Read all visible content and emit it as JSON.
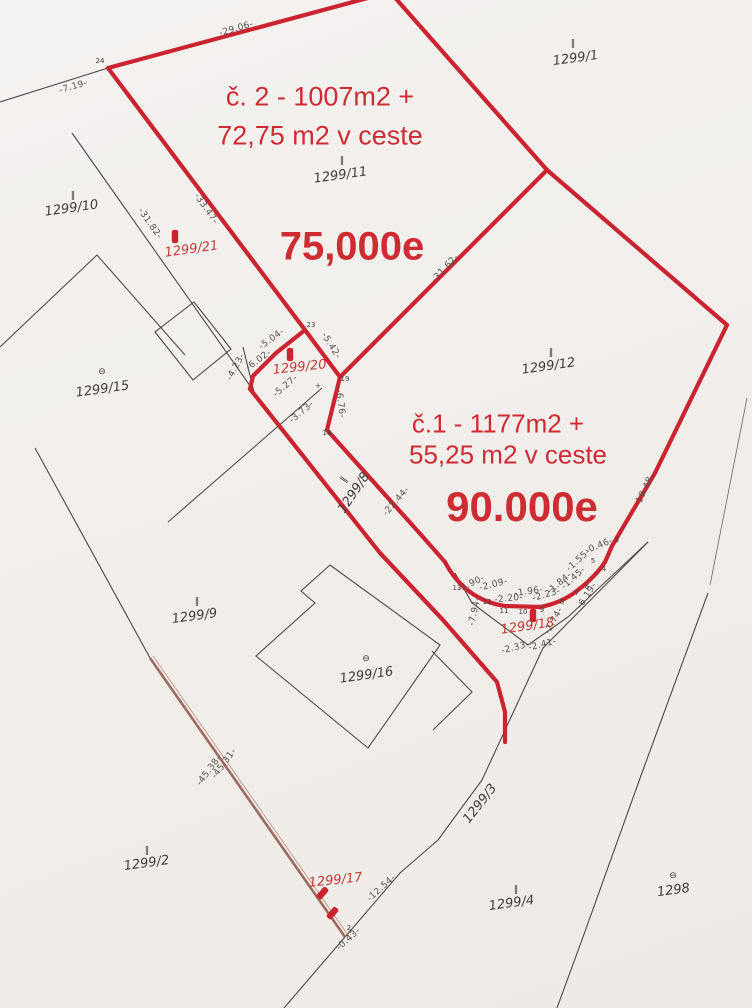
{
  "colors": {
    "paper": "#f2efec",
    "ink": "#4b4947",
    "red_boundary": "#cb2430",
    "red_text": "#cf2b33",
    "brown_line": "#9c6b5f",
    "dimension_text": "#55524d"
  },
  "offers": {
    "parcel2": {
      "line1": "č. 2 - 1007m2 +",
      "line2": "72,75 m2 v ceste",
      "price": "75,000e"
    },
    "parcel1": {
      "line1": "č.1 - 1177m2 +",
      "line2": "55,25 m2 v ceste",
      "price": "90.000e"
    }
  },
  "parcel_labels": [
    {
      "text": "1299/1",
      "x": 576,
      "y": 62,
      "rot": -8,
      "color": "black",
      "marker": "ticks",
      "mx": 573,
      "my": 46
    },
    {
      "text": "1299/10",
      "x": 72,
      "y": 212,
      "rot": -8,
      "color": "black",
      "marker": "ticks",
      "mx": 73,
      "my": 198
    },
    {
      "text": "1299/11",
      "x": 341,
      "y": 179,
      "rot": -8,
      "color": "black",
      "marker": "ticks",
      "mx": 342,
      "my": 163
    },
    {
      "text": "1299/21",
      "x": 192,
      "y": 253,
      "rot": -8,
      "color": "red",
      "marker": "ticks",
      "mx": 175,
      "my": 239
    },
    {
      "text": "1299/15",
      "x": 103,
      "y": 393,
      "rot": -8,
      "color": "black",
      "marker": "theta",
      "mx": 102,
      "my": 374
    },
    {
      "text": "1299/20",
      "x": 300,
      "y": 371,
      "rot": -6,
      "color": "red",
      "marker": "ticks",
      "mx": 290,
      "my": 357
    },
    {
      "text": "1299/12",
      "x": 549,
      "y": 370,
      "rot": -8,
      "color": "black",
      "marker": "ticks",
      "mx": 551,
      "my": 355
    },
    {
      "text": "1299/8",
      "x": 357,
      "y": 495,
      "rot": -56,
      "color": "black",
      "marker": "ticks",
      "mx": 346,
      "my": 481,
      "mrot": -56
    },
    {
      "text": "1299/9",
      "x": 195,
      "y": 620,
      "rot": -8,
      "color": "black",
      "marker": "ticks",
      "mx": 197,
      "my": 604
    },
    {
      "text": "1299/16",
      "x": 367,
      "y": 679,
      "rot": -8,
      "color": "black",
      "marker": "theta",
      "mx": 366,
      "my": 661
    },
    {
      "text": "1299/18",
      "x": 528,
      "y": 630,
      "rot": -8,
      "color": "red",
      "marker": "ticks",
      "mx": 533,
      "my": 618
    },
    {
      "text": "1299/2",
      "x": 147,
      "y": 867,
      "rot": -8,
      "color": "black",
      "marker": "ticks",
      "mx": 147,
      "my": 853
    },
    {
      "text": "1299/17",
      "x": 336,
      "y": 884,
      "rot": -6,
      "color": "red",
      "marker": "none"
    },
    {
      "text": "1299/3",
      "x": 483,
      "y": 806,
      "rot": -52,
      "color": "black",
      "marker": "none"
    },
    {
      "text": "1299/4",
      "x": 512,
      "y": 907,
      "rot": -8,
      "color": "black",
      "marker": "ticks",
      "mx": 516,
      "my": 892
    },
    {
      "text": "1298",
      "x": 674,
      "y": 894,
      "rot": -8,
      "color": "black",
      "marker": "theta",
      "mx": 673,
      "my": 878
    }
  ],
  "dimension_labels": [
    {
      "text": "-29.06-",
      "x": 237,
      "y": 31,
      "rot": -16
    },
    {
      "text": "-7.19-",
      "x": 74,
      "y": 89,
      "rot": -16
    },
    {
      "text": "-33.47-",
      "x": 204,
      "y": 210,
      "rot": 55
    },
    {
      "text": "-31.82-",
      "x": 148,
      "y": 225,
      "rot": 55
    },
    {
      "text": "-31.62-",
      "x": 447,
      "y": 270,
      "rot": -47
    },
    {
      "text": "-5.04-",
      "x": 273,
      "y": 341,
      "rot": -36
    },
    {
      "text": "-5.42-",
      "x": 329,
      "y": 347,
      "rot": 58
    },
    {
      "text": "-6.02-",
      "x": 260,
      "y": 362,
      "rot": -36
    },
    {
      "text": "-4.23-",
      "x": 238,
      "y": 368,
      "rot": -62
    },
    {
      "text": "-5.27-",
      "x": 287,
      "y": 388,
      "rot": -40
    },
    {
      "text": "-3.73-",
      "x": 303,
      "y": 414,
      "rot": -40
    },
    {
      "text": "-6.76-",
      "x": 338,
      "y": 404,
      "rot": 83
    },
    {
      "text": "-22.44-",
      "x": 398,
      "y": 503,
      "rot": -49
    },
    {
      "text": "-19.48-",
      "x": 647,
      "y": 491,
      "rot": -64
    },
    {
      "text": "-2.90-",
      "x": 472,
      "y": 586,
      "rot": -25
    },
    {
      "text": "-2.09-",
      "x": 494,
      "y": 587,
      "rot": -14
    },
    {
      "text": "-2.20-",
      "x": 509,
      "y": 601,
      "rot": -6
    },
    {
      "text": "-1.96-",
      "x": 529,
      "y": 594,
      "rot": -8
    },
    {
      "text": "-2.23-",
      "x": 547,
      "y": 597,
      "rot": -16
    },
    {
      "text": "-1.84-",
      "x": 561,
      "y": 585,
      "rot": -40
    },
    {
      "text": "-1.45-",
      "x": 575,
      "y": 580,
      "rot": -42
    },
    {
      "text": "-1.55-",
      "x": 580,
      "y": 562,
      "rot": -42
    },
    {
      "text": "-0.46-",
      "x": 600,
      "y": 548,
      "rot": -22
    },
    {
      "text": "-6.19-",
      "x": 589,
      "y": 597,
      "rot": -57
    },
    {
      "text": "-7.94-",
      "x": 477,
      "y": 612,
      "rot": -78
    },
    {
      "text": "-2.74-",
      "x": 556,
      "y": 622,
      "rot": -62
    },
    {
      "text": "-2.33-",
      "x": 516,
      "y": 650,
      "rot": -14
    },
    {
      "text": "-2.41-",
      "x": 543,
      "y": 647,
      "rot": -14
    },
    {
      "text": "-45.31-",
      "x": 226,
      "y": 765,
      "rot": -53
    },
    {
      "text": "-45.38-",
      "x": 211,
      "y": 772,
      "rot": -53
    },
    {
      "text": "-12.54-",
      "x": 383,
      "y": 890,
      "rot": -42
    },
    {
      "text": "-0.43-",
      "x": 350,
      "y": 941,
      "rot": -42
    }
  ],
  "point_labels": [
    {
      "text": "24",
      "x": 100,
      "y": 63
    },
    {
      "text": "23",
      "x": 311,
      "y": 327
    },
    {
      "text": "19",
      "x": 345,
      "y": 381
    },
    {
      "text": "18",
      "x": 327,
      "y": 435
    },
    {
      "text": "+",
      "x": 318,
      "y": 388
    },
    {
      "text": "13",
      "x": 457,
      "y": 590
    },
    {
      "text": "12",
      "x": 487,
      "y": 604
    },
    {
      "text": "11",
      "x": 504,
      "y": 613
    },
    {
      "text": "10",
      "x": 523,
      "y": 614
    },
    {
      "text": "9",
      "x": 542,
      "y": 612
    },
    {
      "text": "8",
      "x": 562,
      "y": 604
    },
    {
      "text": "7",
      "x": 577,
      "y": 595
    },
    {
      "text": "6",
      "x": 587,
      "y": 589
    },
    {
      "text": "5",
      "x": 593,
      "y": 563
    },
    {
      "text": "4",
      "x": 604,
      "y": 571
    },
    {
      "text": "3",
      "x": 617,
      "y": 542
    },
    {
      "text": "2",
      "x": 349,
      "y": 930
    }
  ],
  "red_tick_marks": [
    {
      "text": "‖",
      "x": 321,
      "y": 895,
      "rot": 40
    },
    {
      "text": "‖",
      "x": 331,
      "y": 915,
      "rot": 40
    }
  ]
}
